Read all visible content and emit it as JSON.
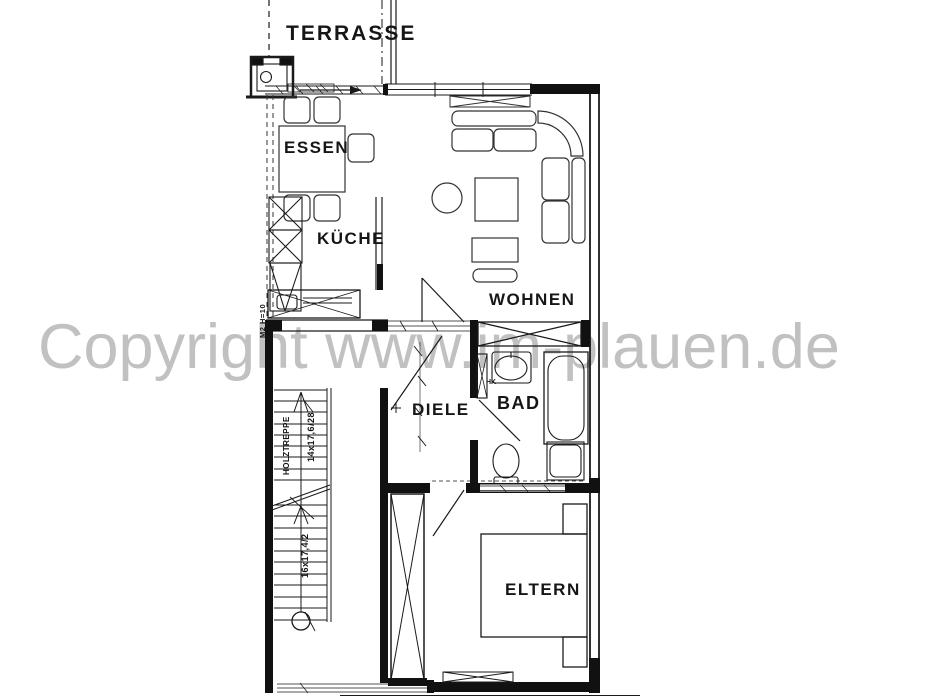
{
  "document_type": "apartment floor plan scan",
  "watermark": {
    "text": "Copyright www.im-plauen.de",
    "color": "#c1c1c1"
  },
  "rooms": {
    "terrasse": "TERRASSE",
    "essen": "ESSEN",
    "kueche": "KÜCHE",
    "wohnen": "WOHNEN",
    "diele": "DIELE",
    "bad": "BAD",
    "eltern": "ELTERN"
  },
  "annotations": {
    "radiator_abbr": "HK",
    "stair_material": "HOLZTREPPE",
    "stair_upper_dim": "14x17,6/28",
    "stair_lower_dim": "16x17,4/2",
    "kitchen_note": "M2 H=10"
  },
  "colors": {
    "line": "#1a1a1a",
    "wall_fill": "#111111",
    "furniture_line": "#333333",
    "background": "#ffffff"
  }
}
